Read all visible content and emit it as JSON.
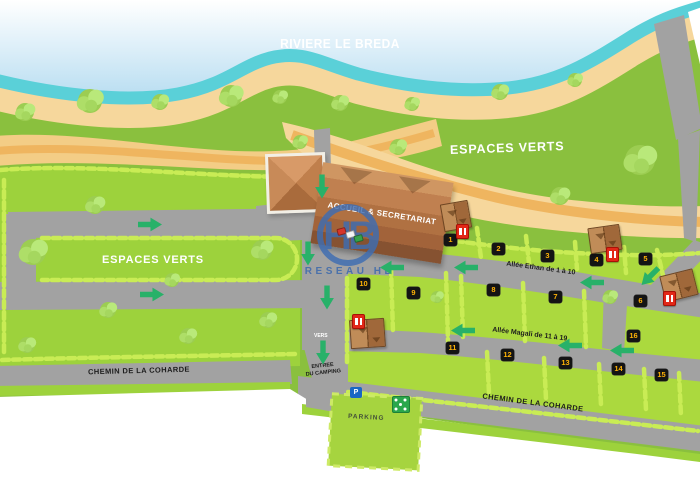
{
  "title": "RIVIERE LE BREDA",
  "areas": {
    "espaces_verts_left": "ESPACES VERTS",
    "espaces_verts_right": "ESPACES VERTS"
  },
  "roads": {
    "allee_ethan": "Allée Ethan de 1 à 10",
    "allee_magali": "Allée Magali de 11 à 19",
    "chemin_left": "CHEMIN DE LA COHARDE",
    "chemin_right": "CHEMIN DE LA COHARDE"
  },
  "buildings": {
    "accueil": "ACCUEIL & SECRETARIAT"
  },
  "entrance": {
    "vers": "VERS",
    "line1": "ENTREE",
    "line2": "DU CAMPING"
  },
  "parking": {
    "label": "PARKING",
    "sign": "P"
  },
  "watermark": {
    "logo": "HB",
    "text": "RESEAU HB"
  },
  "plots": [
    "1",
    "2",
    "3",
    "4",
    "5",
    "6",
    "7",
    "8",
    "9",
    "10",
    "11",
    "12",
    "13",
    "14",
    "15",
    "16"
  ],
  "icons": [
    "parking-sign-icon",
    "playground-icon",
    "electric-post-icon",
    "mobile-home-icon",
    "direction-arrow-icon"
  ],
  "colors": {
    "water": "#5ad0d8",
    "sand": "#f6d79c",
    "sand_path": "#efb55f",
    "green_base": "#8ac03e",
    "green_plot": "#abd93e",
    "road": "#a2a2a2",
    "arrow": "#28b169",
    "badge_bg": "#141414",
    "badge_text": "#ffb207",
    "alert_red": "#e22818",
    "watermark_blue": "#3b69ad"
  }
}
